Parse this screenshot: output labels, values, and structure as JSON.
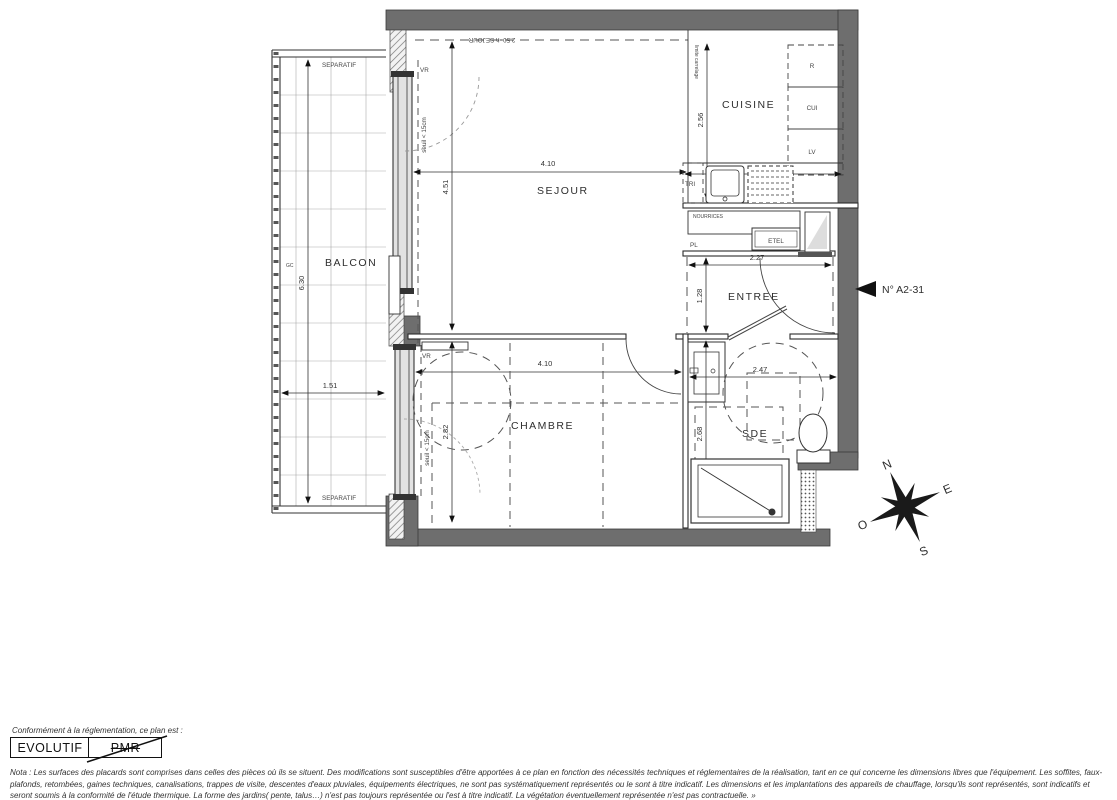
{
  "plan": {
    "unit_number": "N° A2-31",
    "rooms": {
      "balcon": "BALCON",
      "sejour": "SEJOUR",
      "cuisine": "CUISINE",
      "entree": "ENTREE",
      "chambre": "CHAMBRE",
      "sde": "SDE"
    },
    "dims": {
      "balcon_len": "6.30",
      "balcon_w": "1.51",
      "sejour_w": "4.10",
      "sejour_h": "4.51",
      "cuisine_h": "2.56",
      "entree_w": "2.27",
      "entree_h": "1.28",
      "chambre_w": "4.10",
      "chambre_h": "2.82",
      "sde_w": "2.47",
      "sde_h": "2.68"
    },
    "annotations": {
      "separatif_top": "SEPARATIF",
      "separatif_bottom": "SEPARATIF",
      "gc": "GC",
      "vr_sejour": "VR",
      "vr_chambre": "VR",
      "seuil_sejour": "seuil < 15cm",
      "seuil_chambre": "seuil < 15cm",
      "plafond_sejour": "2.50=h SEJOUR",
      "limite_carrelage": "limite carrelage",
      "tri": "TRI",
      "refrigerateur": "R",
      "cuisson": "CUI",
      "lave_vaisselle": "LV",
      "nourrices": "NOURRICES",
      "pl": "PL",
      "etel": "ETEL"
    },
    "compass": {
      "n": "N",
      "e": "E",
      "s": "S",
      "o": "O"
    },
    "colors": {
      "wall": "#6e6e6e",
      "line": "#2e2e2e",
      "dashed": "#555555"
    }
  },
  "legend": {
    "intro": "Conformément à la réglementation, ce plan est :",
    "evolutif": "EVOLUTIF",
    "pmr": "PMR",
    "nota": "Nota : Les surfaces des placards sont comprises dans celles des pièces où ils se situent. Des modifications sont susceptibles d'être apportées à ce plan en fonction des nécessités techniques et réglementaires de la réalisation, tant en ce qui concerne les dimensions libres que l'équipement.  Les soffites, faux-plafonds, retombées, gaines techniques, canalisations, trappes de visite, descentes d'eaux pluviales, équipements électriques, ne sont pas systématiquement représentés ou le sont à titre indicatif. Les dimensions et les implantations des appareils de chauffage, lorsqu'ils sont représentés, sont indicatifs et seront soumis à la conformité de l'étude thermique. La forme des jardins( pente, talus…) n'est pas toujours représentée ou l'est à titre indicatif. La végétation éventuellement représentée n'est pas contractuelle. »"
  }
}
